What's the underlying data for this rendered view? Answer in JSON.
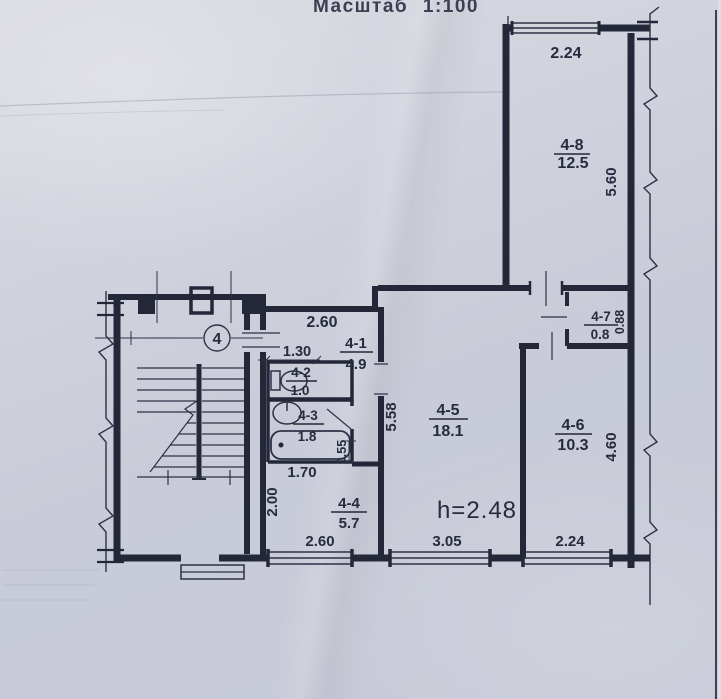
{
  "scale_label": "Масштаб 1:100",
  "unit_circle": "4",
  "ceiling_height": "h=2.48",
  "rooms": [
    {
      "id": "4-1",
      "area": "4.9"
    },
    {
      "id": "4-2",
      "area": "1.0"
    },
    {
      "id": "4-3",
      "area": "1.8"
    },
    {
      "id": "4-4",
      "area": "5.7"
    },
    {
      "id": "4-5",
      "area": "18.1"
    },
    {
      "id": "4-6",
      "area": "10.3"
    },
    {
      "id": "4-7",
      "area": "0.8"
    },
    {
      "id": "4-8",
      "area": "12.5"
    }
  ],
  "dimensions": {
    "window48": "2.24",
    "room48_depth": "5.60",
    "closet47_depth": "0.88",
    "room41_width": "2.60",
    "wc_width": "1.30",
    "room45_depth": "5.58",
    "wall_jog": "0.55",
    "corridor_width": "1.70",
    "corridor_depth": "2.00",
    "window44": "2.60",
    "window45": "3.05",
    "window46": "2.24",
    "room46_depth": "4.60"
  },
  "colors": {
    "paper": "#cdd0da",
    "ink": "#232738"
  }
}
